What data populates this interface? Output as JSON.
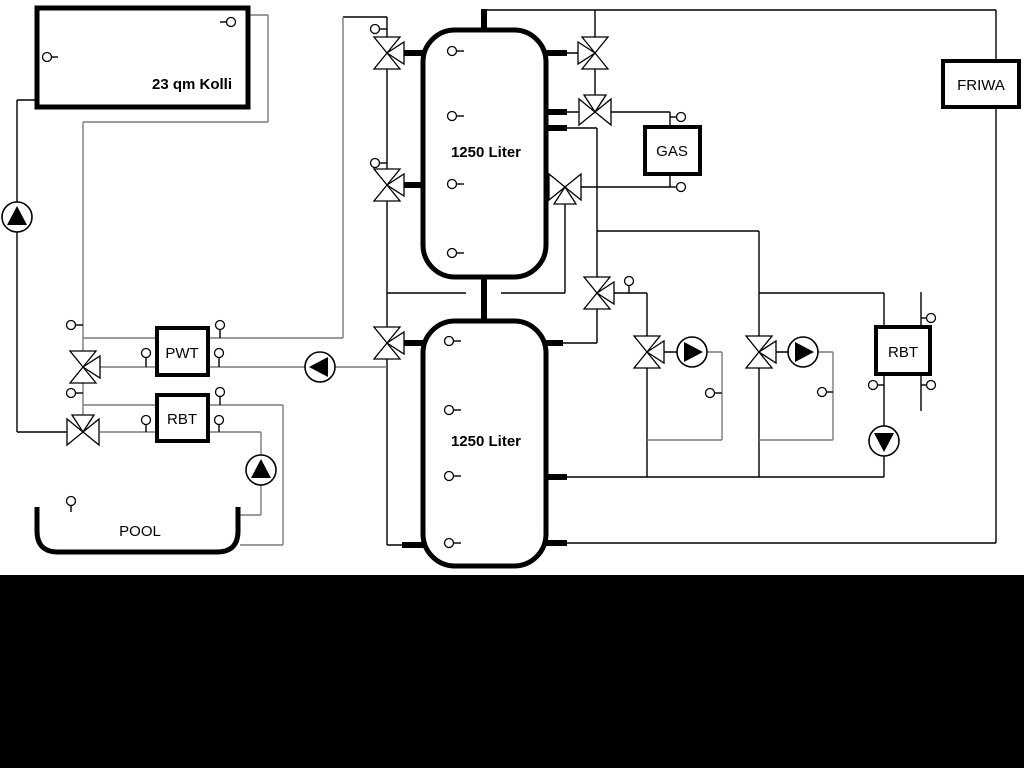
{
  "diagram": {
    "labels": {
      "collector": "23 qm Kolli",
      "tank_top": "1250 Liter",
      "tank_bottom": "1250 Liter",
      "gas": "GAS",
      "friwa": "FRIWA",
      "pwt": "PWT",
      "rbt_left": "RBT",
      "rbt_right": "RBT",
      "pool": "POOL"
    },
    "colors": {
      "primary_line": "#000000",
      "secondary_line": "#7a7a7a",
      "background": "#ffffff",
      "bottom_bar": "#000000"
    }
  }
}
